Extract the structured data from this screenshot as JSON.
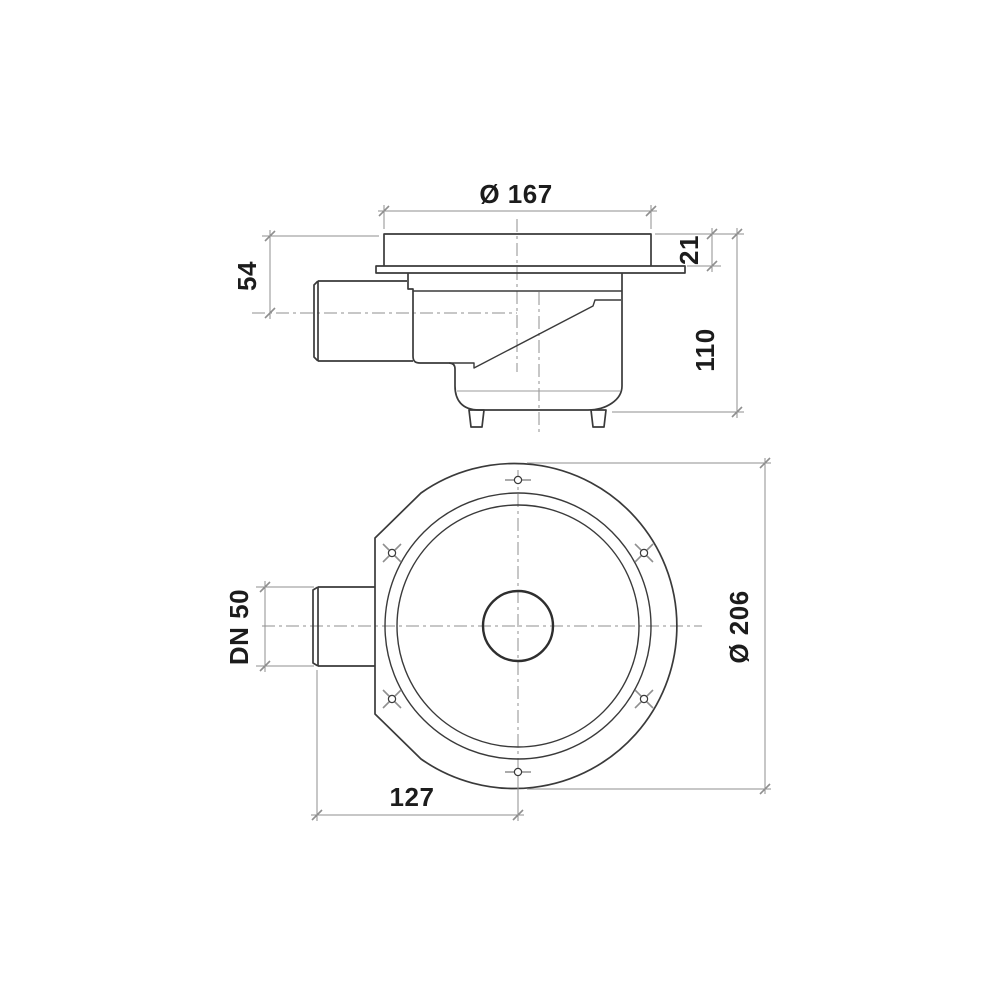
{
  "drawing": {
    "type": "technical-drawing",
    "subject": "floor-drain with side outlet, two orthographic views",
    "colors": {
      "outline": "#3a3a3a",
      "thin_lines": "#8f8f8f",
      "text": "#1c1c1c",
      "background": "#ffffff"
    },
    "side_view": {
      "labels": {
        "top_diameter": "Ø 167",
        "grate_height": "21",
        "inlet_axis_depth": "54",
        "total_height": "110"
      }
    },
    "plan_view": {
      "labels": {
        "outlet_nominal": "DN 50",
        "flange_diameter": "Ø 206",
        "outlet_to_center": "127"
      }
    }
  }
}
